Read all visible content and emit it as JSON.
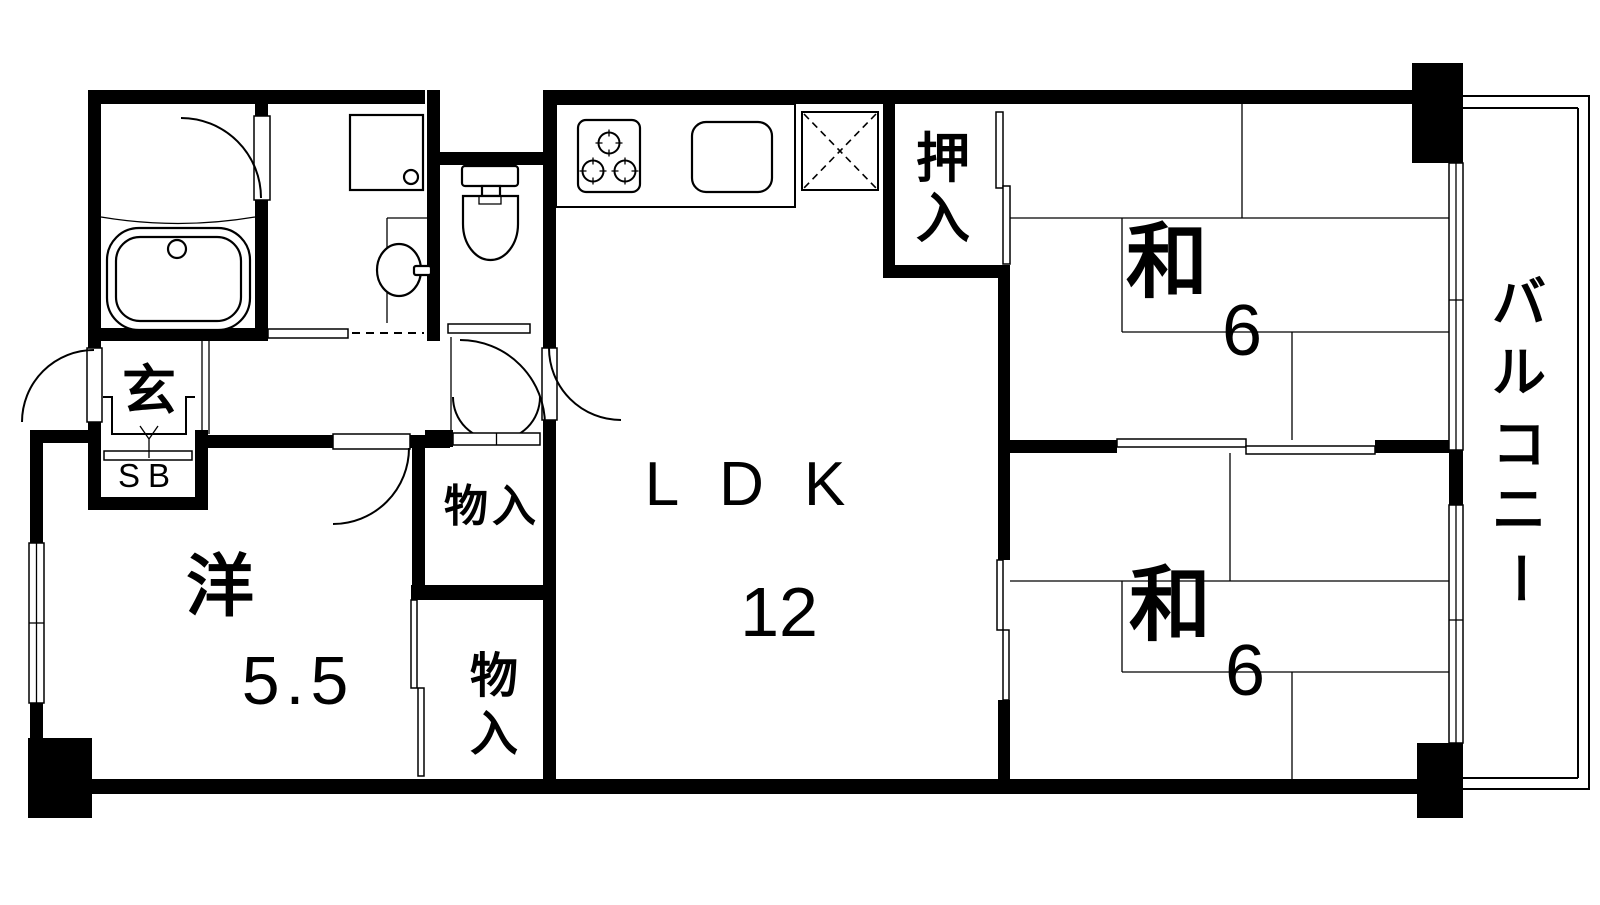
{
  "rooms": {
    "ldk": {
      "name": "LDK",
      "area": "12"
    },
    "western": {
      "name": "洋",
      "area": "5.5"
    },
    "japanese_upper": {
      "name": "和",
      "area": "6"
    },
    "japanese_lower": {
      "name": "和",
      "area": "6"
    },
    "balcony": {
      "name": "バルコニー",
      "chars": [
        "バ",
        "ル",
        "コ",
        "ニ",
        "ー"
      ]
    },
    "oshiire": {
      "name": "押入",
      "chars": [
        "押",
        "入"
      ]
    },
    "storage_upper": {
      "name": "物入"
    },
    "storage_lower": {
      "name": "物入",
      "chars": [
        "物",
        "入"
      ]
    },
    "entrance": {
      "name": "玄"
    },
    "shoebox": {
      "name": "SB"
    }
  },
  "colors": {
    "wall": "#000000",
    "background": "#ffffff",
    "line": "#000000"
  }
}
